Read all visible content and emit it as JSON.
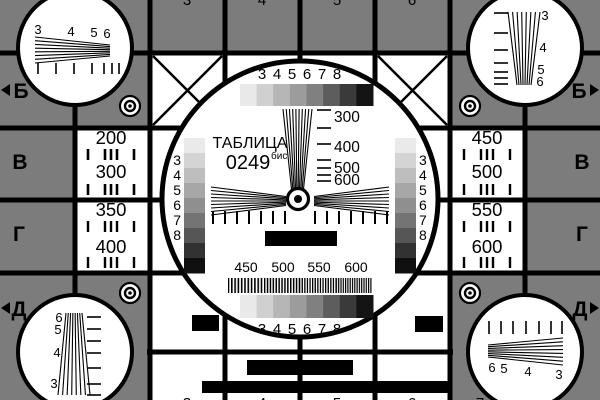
{
  "card": {
    "title": "ТАБЛИЦА",
    "number": "0249",
    "number_suffix": "бис"
  },
  "colors": {
    "background": "#7c7c7c",
    "cell": "#ffffff",
    "line": "#000000",
    "grayscale_steps": [
      "#e9e9e9",
      "#d0d0d0",
      "#b6b6b6",
      "#9c9c9c",
      "#808080",
      "#5d5d5d",
      "#3a3a3a",
      "#141414"
    ],
    "column_steps": [
      "#eaeaea",
      "#d4d4d4",
      "#bebebe",
      "#a7a7a7",
      "#8f8f8f",
      "#747474",
      "#565656",
      "#323232",
      "#101010"
    ]
  },
  "edge_markers": {
    "left": [
      "Б",
      "В",
      "Г",
      "Д"
    ],
    "right": [
      "Б",
      "В",
      "Г",
      "Д"
    ]
  },
  "corner_circles": {
    "top_left_numbers": [
      "3",
      "4",
      "5",
      "6"
    ],
    "top_right_numbers": [
      "3",
      "4",
      "5",
      "6"
    ],
    "bottom_left_numbers": [
      "6",
      "5",
      "4",
      "3"
    ],
    "bottom_right_numbers": [
      "6",
      "5",
      "4",
      "3"
    ]
  },
  "side_cells": {
    "left_top": [
      "200",
      "300"
    ],
    "left_bottom": [
      "350",
      "400"
    ],
    "right_top": [
      "450",
      "500"
    ],
    "right_bottom": [
      "550",
      "600"
    ]
  },
  "center_circle": {
    "top_scale": [
      "3",
      "4",
      "5",
      "6",
      "7",
      "8"
    ],
    "bottom_scale": [
      "3",
      "4",
      "5",
      "6",
      "7",
      "8"
    ],
    "left_column": [
      "3",
      "4",
      "5",
      "6",
      "7",
      "8"
    ],
    "right_column": [
      "3",
      "4",
      "5",
      "6",
      "7",
      "8"
    ],
    "wedge_labels": [
      "300",
      "400",
      "500",
      "600"
    ],
    "frequency_labels": [
      "450",
      "500",
      "550",
      "600"
    ]
  },
  "edge_fragments": {
    "top": [
      "3",
      "4",
      "5",
      "6"
    ],
    "bottom": [
      "3",
      "4",
      "5",
      "6",
      "7"
    ]
  }
}
